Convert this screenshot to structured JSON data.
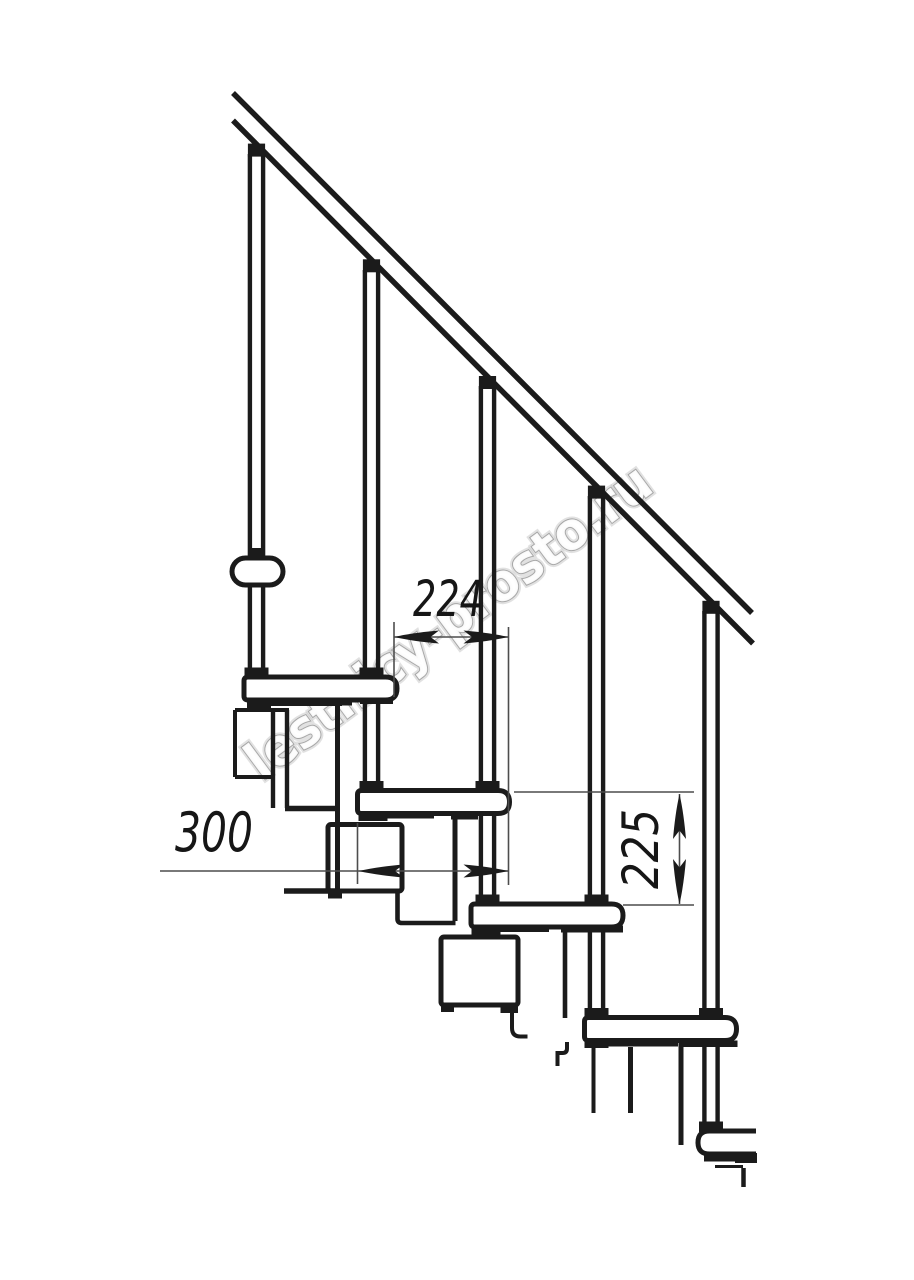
{
  "page": {
    "background": "#ffffff"
  },
  "drawing": {
    "subject": "modular-staircase-side-elevation",
    "stroke_color": "#1b1b1b",
    "thin_line_color": "#4d4d4d"
  },
  "dimensions": {
    "run": {
      "value": "224"
    },
    "tread": {
      "value": "300"
    },
    "rise": {
      "value": "225"
    }
  },
  "watermark": {
    "text": "lestnicy-prosto.ru",
    "fill": "#ffffff",
    "outline": "#9b9b9b"
  }
}
